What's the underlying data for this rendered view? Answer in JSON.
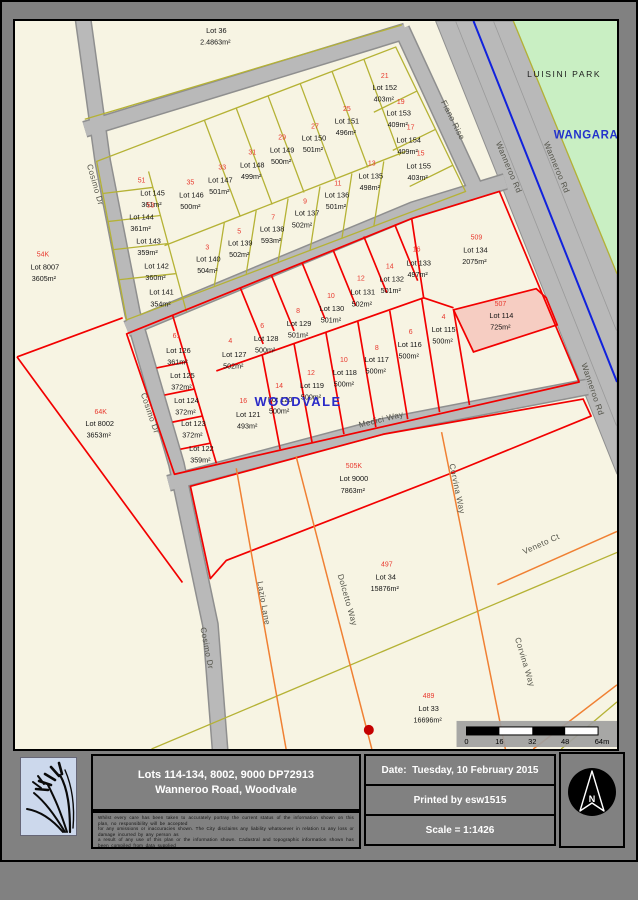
{
  "colors": {
    "parcel_red": "#f20000",
    "survey_yellow": "#b5b235",
    "future_road_orange": "#f08033",
    "road_gray": "#b9b9b9",
    "park_green": "#c9efc3",
    "highlight_pink": "#f6cdc2",
    "divider_blue": "#1122dd",
    "locality_blue": "#2a2ac8"
  },
  "map": {
    "localities": [
      {
        "t": "LUISINI PARK",
        "x": 551,
        "y": 56,
        "cls": "park"
      },
      {
        "t": "WANGARA",
        "x": 573,
        "y": 117,
        "cls": "suburb"
      },
      {
        "t": "WOODVALE",
        "x": 284,
        "y": 384,
        "cls": "woodvale"
      }
    ],
    "street_labels": [
      {
        "t": "Cosimo Dr",
        "x": 78,
        "y": 164,
        "r": 74
      },
      {
        "t": "Cosimo Dr",
        "x": 133,
        "y": 392,
        "r": 71
      },
      {
        "t": "Cosimo Dr",
        "x": 190,
        "y": 626,
        "r": 79
      },
      {
        "t": "Fiano Rise",
        "x": 437,
        "y": 100,
        "r": 63
      },
      {
        "t": "Wanneroo Rd",
        "x": 493,
        "y": 147,
        "r": 67
      },
      {
        "t": "Wanneroo Rd",
        "x": 541,
        "y": 147,
        "r": 67
      },
      {
        "t": "Wanneroo Rd",
        "x": 577,
        "y": 368,
        "r": 71
      },
      {
        "t": "Medici Way",
        "x": 368,
        "y": 400,
        "r": -14
      },
      {
        "t": "Lazio Lane",
        "x": 247,
        "y": 581,
        "r": 80
      },
      {
        "t": "Dolcetto Way",
        "x": 331,
        "y": 578,
        "r": 74
      },
      {
        "t": "Corvina Way",
        "x": 441,
        "y": 467,
        "r": 78
      },
      {
        "t": "Corvina Way",
        "x": 509,
        "y": 640,
        "r": 73
      },
      {
        "t": "Veneto Ct",
        "x": 529,
        "y": 524,
        "r": -24
      }
    ],
    "lots": [
      {
        "n": "Lot 36",
        "a": "2.4863m²",
        "x": 202,
        "y": 12
      },
      {
        "n": "Lot 145",
        "a": "361m²",
        "x": 138,
        "y": 174,
        "s": "51",
        "sx": 127,
        "sy": 161
      },
      {
        "n": "Lot 144",
        "a": "361m²",
        "x": 127,
        "y": 198,
        "s": "53",
        "sx": 136,
        "sy": 186
      },
      {
        "n": "Lot 143",
        "a": "359m²",
        "x": 134,
        "y": 222
      },
      {
        "n": "Lot 142",
        "a": "360m²",
        "x": 142,
        "y": 247
      },
      {
        "n": "Lot 141",
        "a": "354m²",
        "x": 147,
        "y": 273
      },
      {
        "n": "Lot 146",
        "a": "500m²",
        "x": 177,
        "y": 176,
        "s": "35",
        "sx": 176,
        "sy": 163
      },
      {
        "n": "Lot 147",
        "a": "501m²",
        "x": 206,
        "y": 161,
        "s": "33",
        "sx": 208,
        "sy": 148
      },
      {
        "n": "Lot 148",
        "a": "499m²",
        "x": 238,
        "y": 146,
        "s": "31",
        "sx": 238,
        "sy": 133
      },
      {
        "n": "Lot 149",
        "a": "500m²",
        "x": 268,
        "y": 131,
        "s": "29",
        "sx": 268,
        "sy": 118
      },
      {
        "n": "Lot 150",
        "a": "501m²",
        "x": 300,
        "y": 119,
        "s": "27",
        "sx": 301,
        "sy": 107
      },
      {
        "n": "Lot 151",
        "a": "496m²",
        "x": 333,
        "y": 102,
        "s": "25",
        "sx": 333,
        "sy": 90
      },
      {
        "n": "Lot 152",
        "a": "403m²",
        "x": 371,
        "y": 69,
        "s": "21",
        "sx": 371,
        "sy": 57
      },
      {
        "n": "Lot 153",
        "a": "409m²",
        "x": 385,
        "y": 94,
        "s": "19",
        "sx": 387,
        "sy": 83
      },
      {
        "n": "Lot 154",
        "a": "409m²",
        "x": 395,
        "y": 121,
        "s": "17",
        "sx": 397,
        "sy": 108
      },
      {
        "n": "Lot 155",
        "a": "403m²",
        "x": 405,
        "y": 147,
        "s": "15",
        "sx": 407,
        "sy": 134
      },
      {
        "n": "Lot 135",
        "a": "498m²",
        "x": 357,
        "y": 157,
        "s": "13",
        "sx": 358,
        "sy": 144
      },
      {
        "n": "Lot 136",
        "a": "501m²",
        "x": 323,
        "y": 176,
        "s": "11",
        "sx": 324,
        "sy": 164
      },
      {
        "n": "Lot 137",
        "a": "502m²",
        "x": 293,
        "y": 194,
        "ax": 289,
        "ay": 206,
        "s": "9",
        "sx": 291,
        "sy": 182
      },
      {
        "n": "Lot 138",
        "a": "593m²",
        "x": 258,
        "y": 210,
        "s": "7",
        "sx": 259,
        "sy": 198
      },
      {
        "n": "Lot 139",
        "a": "502m²",
        "x": 226,
        "y": 224,
        "s": "5",
        "sx": 225,
        "sy": 212
      },
      {
        "n": "Lot 140",
        "a": "504m²",
        "x": 194,
        "y": 240,
        "s": "3",
        "sx": 193,
        "sy": 228
      },
      {
        "n": "Lot 126",
        "a": "361m²",
        "x": 164,
        "y": 331,
        "s": "61",
        "sx": 162,
        "sy": 316
      },
      {
        "n": "Lot 125",
        "a": "372m²",
        "x": 168,
        "y": 356
      },
      {
        "n": "Lot 124",
        "a": "372m²",
        "x": 172,
        "y": 381
      },
      {
        "n": "Lot 123",
        "a": "372m²",
        "x": 179,
        "y": 404
      },
      {
        "n": "Lot 122",
        "a": "359m²",
        "x": 187,
        "y": 429
      },
      {
        "n": "Lot 127",
        "a": "502m²",
        "x": 220,
        "y": 335,
        "s": "4",
        "sx": 216,
        "sy": 321
      },
      {
        "n": "Lot 128",
        "a": "500m²",
        "x": 252,
        "y": 319,
        "s": "6",
        "sx": 248,
        "sy": 306
      },
      {
        "n": "Lot 129",
        "a": "501m²",
        "x": 285,
        "y": 304,
        "s": "8",
        "sx": 284,
        "sy": 291
      },
      {
        "n": "Lot 130",
        "a": "501m²",
        "x": 318,
        "y": 289,
        "s": "10",
        "sx": 317,
        "sy": 276
      },
      {
        "n": "Lot 131",
        "a": "502m²",
        "x": 349,
        "y": 273,
        "s": "12",
        "sx": 347,
        "sy": 259
      },
      {
        "n": "Lot 132",
        "a": "501m²",
        "x": 378,
        "y": 260,
        "s": "14",
        "sx": 376,
        "sy": 247
      },
      {
        "n": "Lot 133",
        "a": "497m²",
        "x": 405,
        "y": 244,
        "s": "16",
        "sx": 403,
        "sy": 230
      },
      {
        "n": "Lot 134",
        "a": "2075m²",
        "x": 462,
        "y": 231,
        "s": "509",
        "sx": 463,
        "sy": 218
      },
      {
        "n": "Lot 114",
        "a": "725m²",
        "x": 488,
        "y": 296,
        "s": "507",
        "sx": 487,
        "sy": 284
      },
      {
        "n": "Lot 115",
        "a": "500m²",
        "x": 430,
        "y": 310,
        "s": "4",
        "sx": 430,
        "sy": 297
      },
      {
        "n": "Lot 116",
        "a": "500m²",
        "x": 396,
        "y": 325,
        "s": "6",
        "sx": 397,
        "sy": 312
      },
      {
        "n": "Lot 117",
        "a": "500m²",
        "x": 363,
        "y": 340,
        "s": "8",
        "sx": 363,
        "sy": 328
      },
      {
        "n": "Lot 118",
        "a": "500m²",
        "x": 331,
        "y": 353,
        "s": "10",
        "sx": 330,
        "sy": 340
      },
      {
        "n": "Lot 119",
        "a": "500m²",
        "x": 298,
        "y": 366,
        "s": "12",
        "sx": 297,
        "sy": 353
      },
      {
        "n": "Lot 120",
        "a": "500m²",
        "x": 266,
        "y": 380,
        "s": "14",
        "sx": 265,
        "sy": 366
      },
      {
        "n": "Lot 121",
        "a": "493m²",
        "x": 234,
        "y": 395,
        "s": "16",
        "sx": 229,
        "sy": 381
      },
      {
        "n": "Lot 8007",
        "a": "3605m²",
        "x": 30,
        "y": 248,
        "s": "54K",
        "sx": 28,
        "sy": 235
      },
      {
        "n": "Lot 8002",
        "a": "3653m²",
        "x": 85,
        "y": 404,
        "s": "64K",
        "sx": 86,
        "sy": 392
      },
      {
        "n": "Lot 9000",
        "a": "7863m²",
        "x": 340,
        "y": 459,
        "s": "505K",
        "sx": 340,
        "sy": 446
      },
      {
        "n": "Lot 34",
        "a": "15876m²",
        "x": 372,
        "y": 557,
        "s": "497",
        "sx": 373,
        "sy": 544
      },
      {
        "n": "Lot 33",
        "a": "16696m²",
        "x": 415,
        "y": 688,
        "s": "489",
        "sx": 415,
        "sy": 675
      }
    ],
    "scalebar": {
      "labels": [
        {
          "t": "0",
          "x": 453
        },
        {
          "t": "16",
          "x": 486
        },
        {
          "t": "32",
          "x": 519
        },
        {
          "t": "48",
          "x": 552
        },
        {
          "t": "64m",
          "x": 589
        }
      ]
    }
  },
  "footer": {
    "title_line1": "Lots 114-134, 8002, 9000 DP72913",
    "title_line2": "Wanneroo Road, Woodvale",
    "date_line": "Date:  Tuesday, 10 February 2015",
    "printed_line": "Printed by esw1515",
    "scale_line": "Scale = 1:1426",
    "north_label": "N",
    "fine_print": [
      "Whilst every care has been taken to accurately portray the current status of the information shown on this plan, no responsibility will be accepted",
      "for any omissions or inaccuracies shown. The City disclaims any liability whatsoever in relation to any loss or damage incurred by any person as",
      "a result of any use of this plan or the information shown. Cadastral and topographic information shown has been compiled from data supplied",
      "by Landgate and other sources. © This document is protected by copyright."
    ]
  }
}
